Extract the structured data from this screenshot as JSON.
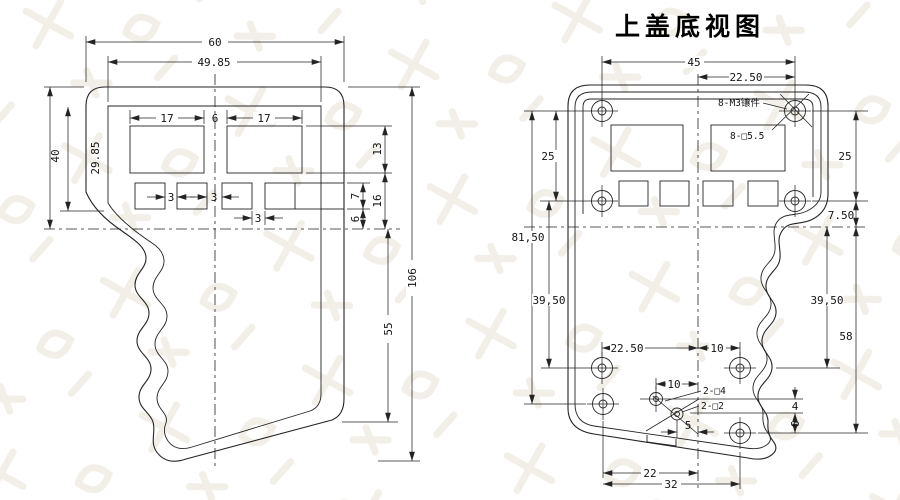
{
  "title": "上盖底视图",
  "left_view": {
    "dims": {
      "outer_width": "60",
      "inner_width": "49.85",
      "display_left_width": "17",
      "display_gap": "6",
      "display_right_width": "17",
      "outer_height": "40",
      "inner_height": "29.85",
      "display_height": "13",
      "display_to_center": "16",
      "button_height": "7",
      "button_to_center": "6",
      "button_gap1": "3",
      "button_gap2": "3",
      "button_gap3": "3",
      "total_height": "106",
      "lower_height": "55"
    }
  },
  "right_view": {
    "dims": {
      "hole_span": "45",
      "hole_half_span": "22.50",
      "left_hole_pitch": "25",
      "right_hole_pitch": "25",
      "center_offset": "7.50",
      "left_col_height": "81,50",
      "left_lower_pitch": "39,50",
      "right_lower_pitch": "39,50",
      "right_col_height": "58",
      "bottom_left_pitch": "22.50",
      "bottom_right_pitch": "10",
      "small_hole_offset": "10",
      "square4_offset": "4",
      "square2_offset": "6",
      "center_gap": "5",
      "bottom_span_inner": "22",
      "bottom_span_outer": "32"
    },
    "labels": {
      "insert_note": "8-M3镶件",
      "boss_note": "8-□5.5",
      "square4_note": "2-□4",
      "square2_note": "2-□2"
    }
  }
}
